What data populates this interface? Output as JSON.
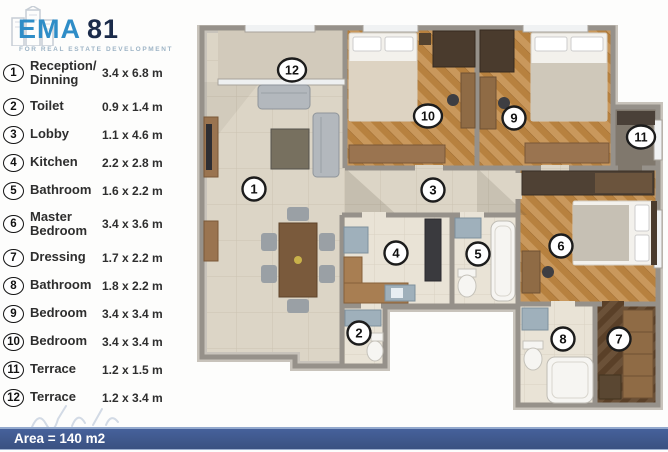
{
  "logo": {
    "brand": "EMA",
    "number": "81",
    "tagline": "FOR REAL ESTATE DEVELOPMENT"
  },
  "legend": [
    {
      "num": "1",
      "name": "Reception/ Dinning",
      "dims": "3.4 x 6.8 m"
    },
    {
      "num": "2",
      "name": "Toilet",
      "dims": "0.9 x 1.4 m"
    },
    {
      "num": "3",
      "name": "Lobby",
      "dims": "1.1 x 4.6 m"
    },
    {
      "num": "4",
      "name": "Kitchen",
      "dims": "2.2 x 2.8 m"
    },
    {
      "num": "5",
      "name": "Bathroom",
      "dims": "1.6 x 2.2 m"
    },
    {
      "num": "6",
      "name": "Master Bedroom",
      "dims": "3.4 x 3.6 m"
    },
    {
      "num": "7",
      "name": "Dressing",
      "dims": "1.7 x 2.2 m"
    },
    {
      "num": "8",
      "name": "Bathroom",
      "dims": "1.8 x 2.2 m"
    },
    {
      "num": "9",
      "name": "Bedroom",
      "dims": "3.4 x 3.4 m"
    },
    {
      "num": "10",
      "name": "Bedroom",
      "dims": "3.4 x 3.4 m"
    },
    {
      "num": "11",
      "name": "Terrace",
      "dims": "1.2 x 1.5 m"
    },
    {
      "num": "12",
      "name": "Terrace",
      "dims": "1.2 x 3.4 m"
    }
  ],
  "plan": {
    "markers": [
      {
        "num": "1",
        "x": 89,
        "y": 164
      },
      {
        "num": "2",
        "x": 194,
        "y": 308
      },
      {
        "num": "3",
        "x": 268,
        "y": 165
      },
      {
        "num": "4",
        "x": 231,
        "y": 228
      },
      {
        "num": "5",
        "x": 313,
        "y": 229
      },
      {
        "num": "6",
        "x": 396,
        "y": 221
      },
      {
        "num": "7",
        "x": 454,
        "y": 314
      },
      {
        "num": "8",
        "x": 398,
        "y": 314
      },
      {
        "num": "9",
        "x": 349,
        "y": 93
      },
      {
        "num": "10",
        "x": 263,
        "y": 91
      },
      {
        "num": "11",
        "x": 476,
        "y": 112
      },
      {
        "num": "12",
        "x": 127,
        "y": 45
      }
    ]
  },
  "footer": {
    "area_label": "Area = 140 m2"
  },
  "colors": {
    "bar_blue": "#3a5181",
    "brand_blue": "#2f8dc7",
    "brand_navy": "#1b2b4a",
    "wall_gray": "#96918a",
    "wood": "#c3914f"
  }
}
